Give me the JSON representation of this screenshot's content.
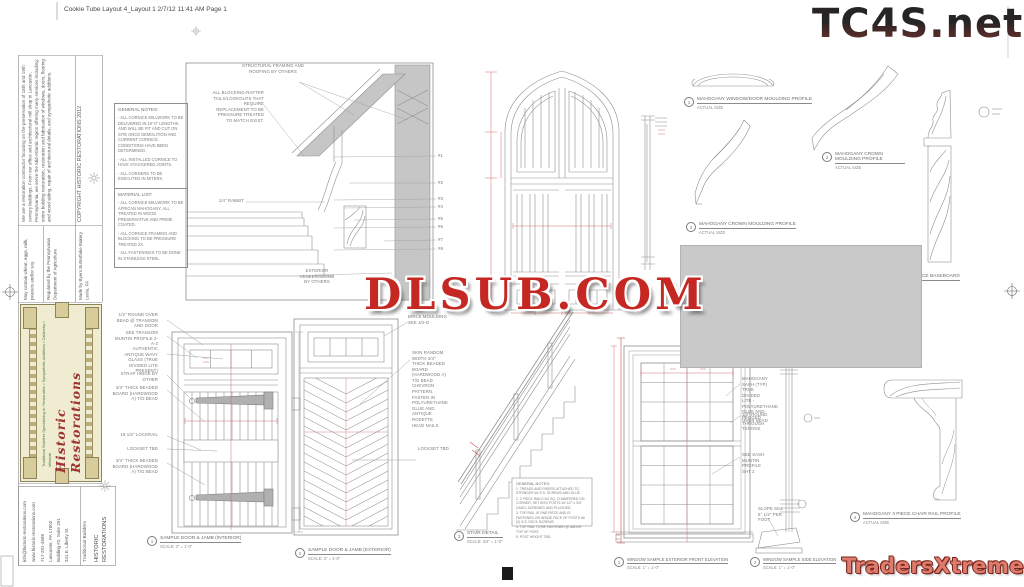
{
  "page": {
    "header": "Cookie Tube Layout 4_Layout 1  2/7/12  11:41 AM  Page 1"
  },
  "colors": {
    "watermark_red": "#c52723",
    "traders_red": "#dd7b6d",
    "line_gray": "#8a8a8a",
    "fill_gray": "#c9c9c9",
    "label_cream": "#efecd2",
    "script_red": "#9e3430"
  },
  "watermarks": {
    "tc4s": "TC4S.net",
    "dlsub": "DLSUB.COM",
    "traders": "TradersXtreme.com"
  },
  "sidebar": {
    "copyright": "COPYRIGHT HISTORIC RESTORATIONS 2012",
    "about": "We are a restoration contractor focusing on the preservation of 18th and 19th century buildings. From our office and architectural mill shop in Lancaster, Pennsylvania, we serve the Mid-Atlantic region offering many services including: entire building restoration, restoration and fabrication of windows, doors, flooring and wood siding, repair of architectural details, and sympathetic additions.",
    "made_by": "Made by Byers Butterflake Bakery Leola, PA",
    "regulated": "Regulated by the Pennsylvania Department of Agriculture",
    "allergens": "May contain wheat, eggs, milk, peanuts and/or soy.",
    "brand_script": "Historic Restorations",
    "brand_tagline": "Traditional Builders Specializing in: Restoration • Sympathetic Additions • Cabinetry • Millwork",
    "footer": {
      "company": "HISTORIC RESTORATIONS",
      "tagline": "Traditional Builders",
      "addr1": "341 E. Liberty St.",
      "addr2": "Building #2, Suite 201",
      "city": "Lancaster, PA 17602",
      "phone": "717-291-4688",
      "web": "www.historic-restorations.com",
      "email": "info@historic-restorations.com"
    }
  },
  "notes_general": {
    "title": "GENERAL NOTES:",
    "i0": "- ALL CORNICE MILLWORK TO BE DELIVERED IN 10'-0\" LENGTHS AND WILL BE FIT AND CUT ON SITE ONCE DEMOLITION AND CURRENT CORNICE CONDITIONS HAVE BEEN DETERMINED.",
    "i1": "- ALL INSTALLED CORNICE TO HAVE STAGGERED JOINTS.",
    "i2": "- ALL CORNERS TO BE EXECUTED IN MITERS."
  },
  "notes_material": {
    "title": "MATERIAL LIST:",
    "i0": "- ALL CORNICE MILLWORK TO BE AFRICAN MAHOGANY, ALL TREATED IN WOOD PRESERVATIVE AND PRIME COATED.",
    "i1": "- ALL CORNICE FRAMING AND BLOCKING TO BE PRESSURE TREATED 2X.",
    "i2": "- ALL FASTENINGS TO BE DONE IN STAINLESS STEEL."
  },
  "cornice": {
    "blocking": "ALL BLOCKING-RAFTER TAILS/LOOKOUTS THAT REQUIRE REPLACEMENT TO BE PRESSURE TREATED TO MATCH EXIST.",
    "structural": "STRUCTURAL FRAMING AND ROOFING BY OTHERS",
    "rabbit": "1/4\" RABBIT",
    "veneer": "EXTERIOR VENEER/SIDING BY OTHERS",
    "c1": "#1",
    "c2": "#2",
    "c3": "#3",
    "c4": "#4",
    "c5": "#5",
    "c6": "#6",
    "c7": "#7",
    "c8": "#8"
  },
  "profiles": {
    "p1_num": "1",
    "p1_title": "MAHOGANY WINDOW/DOOR MOULDING PROFILE",
    "p2_num": "2",
    "p2_title": "MAHOGANY CROWN MOULDING PROFILE",
    "p3_num": "3",
    "p3_title": "MAHOGANY CROWN MOULDING PROFILE",
    "bb_title": "MAHOGANY 2 PIECE BASEBOARD",
    "cr_num": "4",
    "cr_title": "MAHOGANY 3 PIECE CHAIR RAIL PROFILE",
    "actual": "ACTUAL SIZE"
  },
  "door_int": {
    "n0": "1/2\" ROUND OVER BEAD @ TRANSOM AND DOOR",
    "n1": "SEE TRANSOM MUNTIN PROFILE 2-A-2",
    "n2": "AUTHENTIC ANTIQUE WAVY GLASS (TRUE DIVIDED LITE PRESENT)",
    "n3": "STRAP HINGE BY OTHER",
    "n4": "3/4\" THICK BEADED BOARD (HARDWOOD A) T/G BEAD",
    "n5": "18 1/2\" LOCKRAIL",
    "n6": "LOCKSET TBD",
    "n7": "3/4\" THICK BEADED BOARD (HARDWOOD A) T/G BEAD",
    "cap_num": "1",
    "cap": "SAMPLE DOOR & JAMB (INTERIOR)",
    "scale": "SCALE: 3\" = 1'-0\""
  },
  "door_ext": {
    "brick": "BRICK MOULDING SEE 4/2-D",
    "skin": "SKIN RANDOM WIDTH 3/4\" THICK BEADED BOARD (HARDWOOD A) T/G BEAD CHEVRON PATTERN. FASTEN IN POLYURETHANE GLUE AND ANTIQUE ROSETTE HEAD NAILS",
    "lockset": "LOCKSET TBD",
    "cap_num": "2",
    "cap": "SAMPLE DOOR & JAMB (EXTERIOR)",
    "scale": "SCALE: 3\" = 1'-0\""
  },
  "stair": {
    "notes_title": "GENERAL NOTES:",
    "n0": "1. TREADS AND RISERS ATTACHED TO STRINGER W/ S.S. SCREWS AND GLUE.",
    "n1": "2. 2 PIECE RAILS 5/4 SQ. CHAMFERED ON CORNER, SET INTO POSTS W/ 1/2\" x 3/4\" DADO, SCREWED AND PLUGGED.",
    "n2": "3. TOP RAIL IS ONE PIECE AND IS FASTENED ON INSIDE FACE OF POSTS W/ (2) S.S. DECK SCREWS.",
    "n3": "4. TOP RAIL TO BE FASTENED @ ABOVE TOP OF POST.",
    "n4": "5. POST HEIGHT TBD.",
    "cap_num": "3",
    "cap": "STAIR DETAIL",
    "scale": "SCALE: 3/4\" = 1'-0\""
  },
  "window": {
    "sash": "MAHOGANY SASH (TYP) TRUE DIVIDED LITE - POLYURETHANE GLUE AND PEGGED THROUGH TENONS",
    "bead": "1/2\" ROUND OVER BEAD",
    "muntin": "SEE SASH MUNTIN PROFILE SHT 2",
    "sill": "SLOPE SILL 5° 1/2\" PER FOOT",
    "cap1_num": "1",
    "cap1": "WINDOW SAMPLE EXTERIOR FRONT ELEVATION",
    "cap2_num": "2",
    "cap2": "WINDOW SAMPLE SIDE ELEVATION",
    "scale": "SCALE: 1\" = 1'-0\""
  }
}
